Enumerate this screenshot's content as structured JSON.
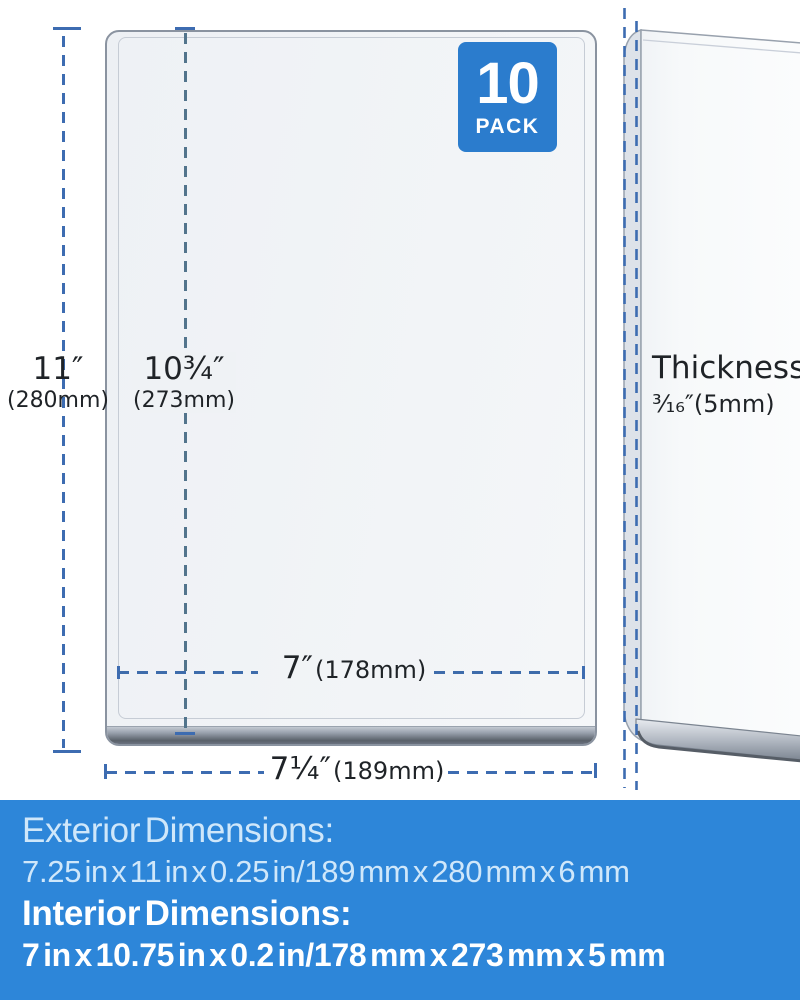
{
  "badge": {
    "count": "10",
    "label": "PACK"
  },
  "front_view": {
    "height_exterior": {
      "value": "11″",
      "metric": "(280mm)"
    },
    "height_interior": {
      "value": "10¾″",
      "metric": "(273mm)"
    },
    "width_interior": {
      "value": "7″",
      "metric": "(178mm)"
    },
    "width_exterior": {
      "value": "7¼″",
      "metric": "(189mm)"
    }
  },
  "side_view": {
    "label": "Thickness",
    "value": "³⁄₁₆″(5mm)"
  },
  "banner": {
    "exterior_title": "Exterior Dimensions:",
    "exterior_value": "7.25 in x 11 in x 0.25 in/189 mm x 280 mm x 6 mm",
    "interior_title": "Interior Dimensions:",
    "interior_value": "7 in x 10.75 in x 0.2 in/178 mm x 273 mm x 5 mm"
  },
  "colors": {
    "banner_blue": "#2d86d9",
    "badge_blue": "#2b7ccd",
    "dim_blue": "#3d6cb1",
    "interior_line_slate": "#52748c",
    "interior_line_blue": "#3e6cab",
    "banner_light_text": "#cfe7fa",
    "banner_bold_text": "#ffffff",
    "label_text": "#1f2327"
  }
}
